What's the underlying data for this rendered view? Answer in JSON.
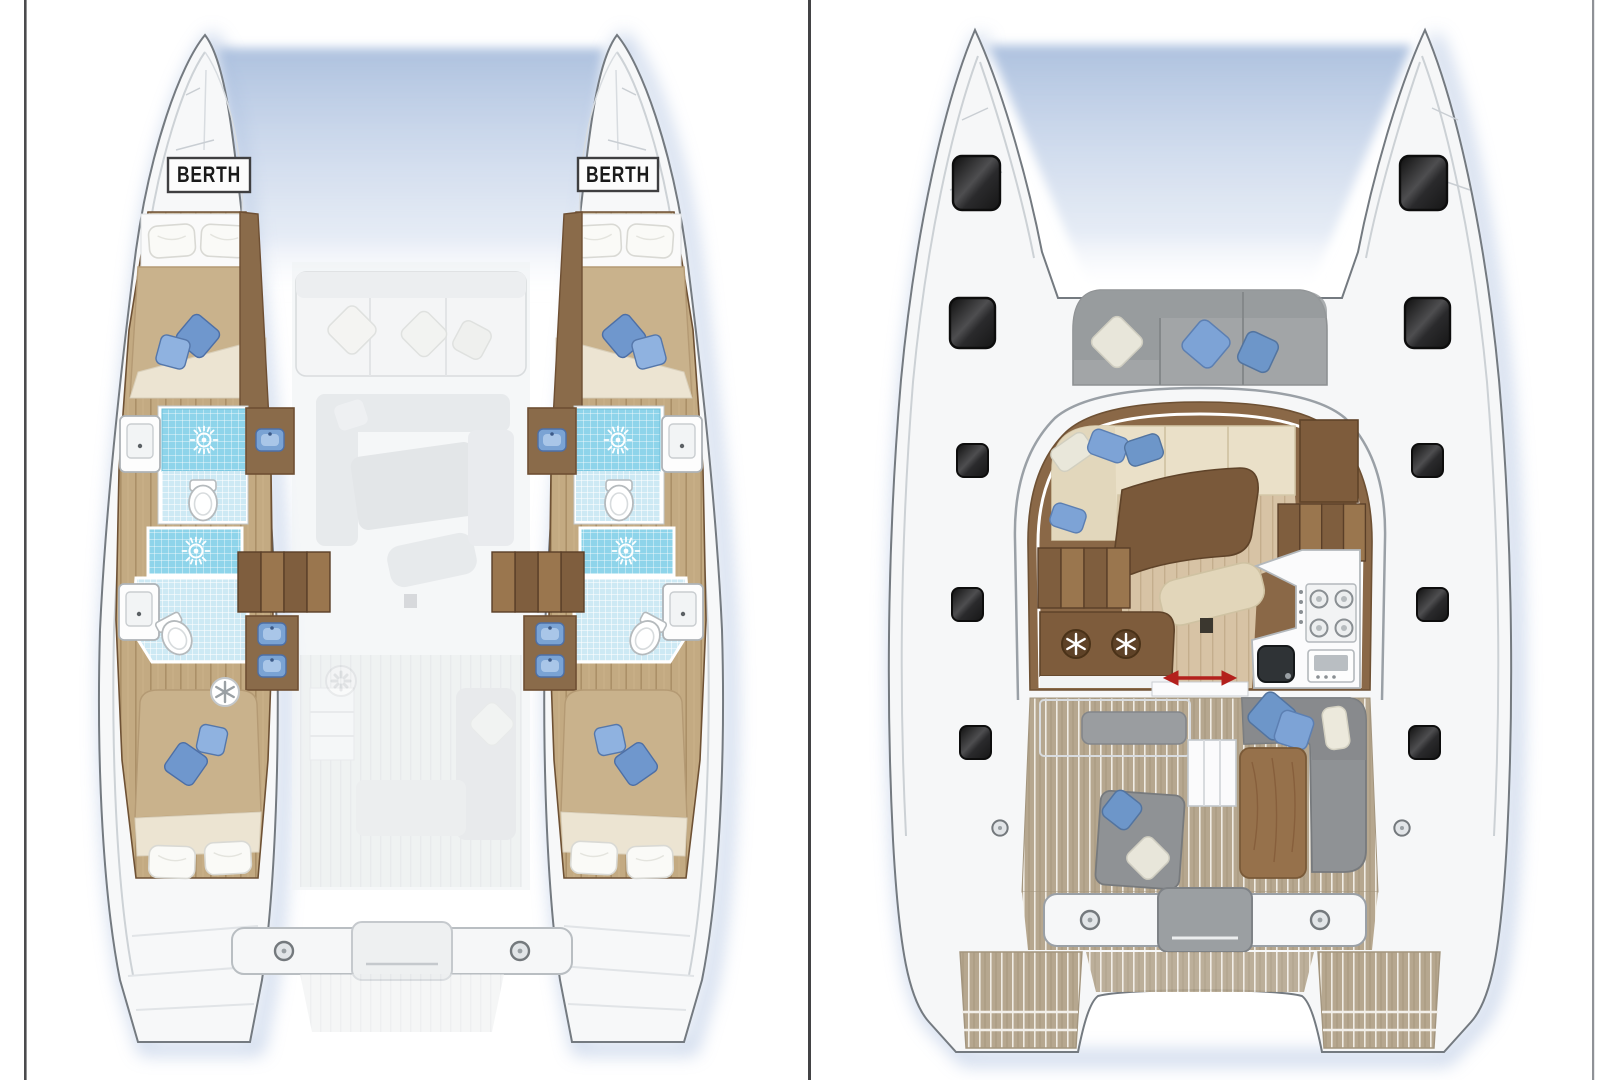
{
  "document": {
    "title": "Catamaran layout plan - two deck views",
    "background": "#ffffff"
  },
  "frame": {
    "left_line_color": "#4b4b4d",
    "divider_color": "#434345",
    "right_line_color": "#8f9196"
  },
  "colors": {
    "hull-fill": "#f7f8f9",
    "hull-stroke": "#747a80",
    "shadow-blue": "#b3c5e2",
    "wood-floor": "#c3aa82",
    "wood-dark": "#6e4f33",
    "cabinet": "#8a6b4a",
    "shower-blue": "#8ed4ea",
    "bath-pale": "#cde9f4",
    "mattress": "#c9b28c",
    "blanket": "#ece4d2",
    "cushion-blue": "#6f97cd",
    "cushion-blue2": "#8fb2e0",
    "ghost": "#dadde0",
    "seat-gray": "#9a9da0",
    "salon-border": "#8a6847",
    "salon-floor": "#d7c3a5",
    "table-brown": "#7a593a",
    "teak": "#b6a78f",
    "hatch-dark": "#141414",
    "arrow-red": "#b3201c"
  },
  "left_plan": {
    "name": "Hull accommodation plan (cabins deck)",
    "berth_labels": [
      "BERTH",
      "BERTH"
    ],
    "features": [
      "4 double cabins",
      "4 bathrooms with shower",
      "2 forepeak berths",
      "companionway stairs",
      "vanity basins",
      "fridge"
    ]
  },
  "right_plan": {
    "name": "Main deck plan (salon, galley, cockpit)",
    "features": [
      "bow lounge seating",
      "deck hatches",
      "salon L-sofa",
      "coffee table",
      "galley with stove, oven and sink",
      "twin fridges",
      "sliding door",
      "aft cockpit sofas",
      "cockpit table",
      "swim platforms"
    ]
  },
  "icons": {
    "shower": "sun-rose-icon",
    "fridge": "snowflake-icon",
    "stove": "four-burner-icon",
    "sliding_door": "red-double-arrow-icon",
    "cleat": "round-fitting-icon",
    "hatch": "dark-deck-hatch"
  }
}
